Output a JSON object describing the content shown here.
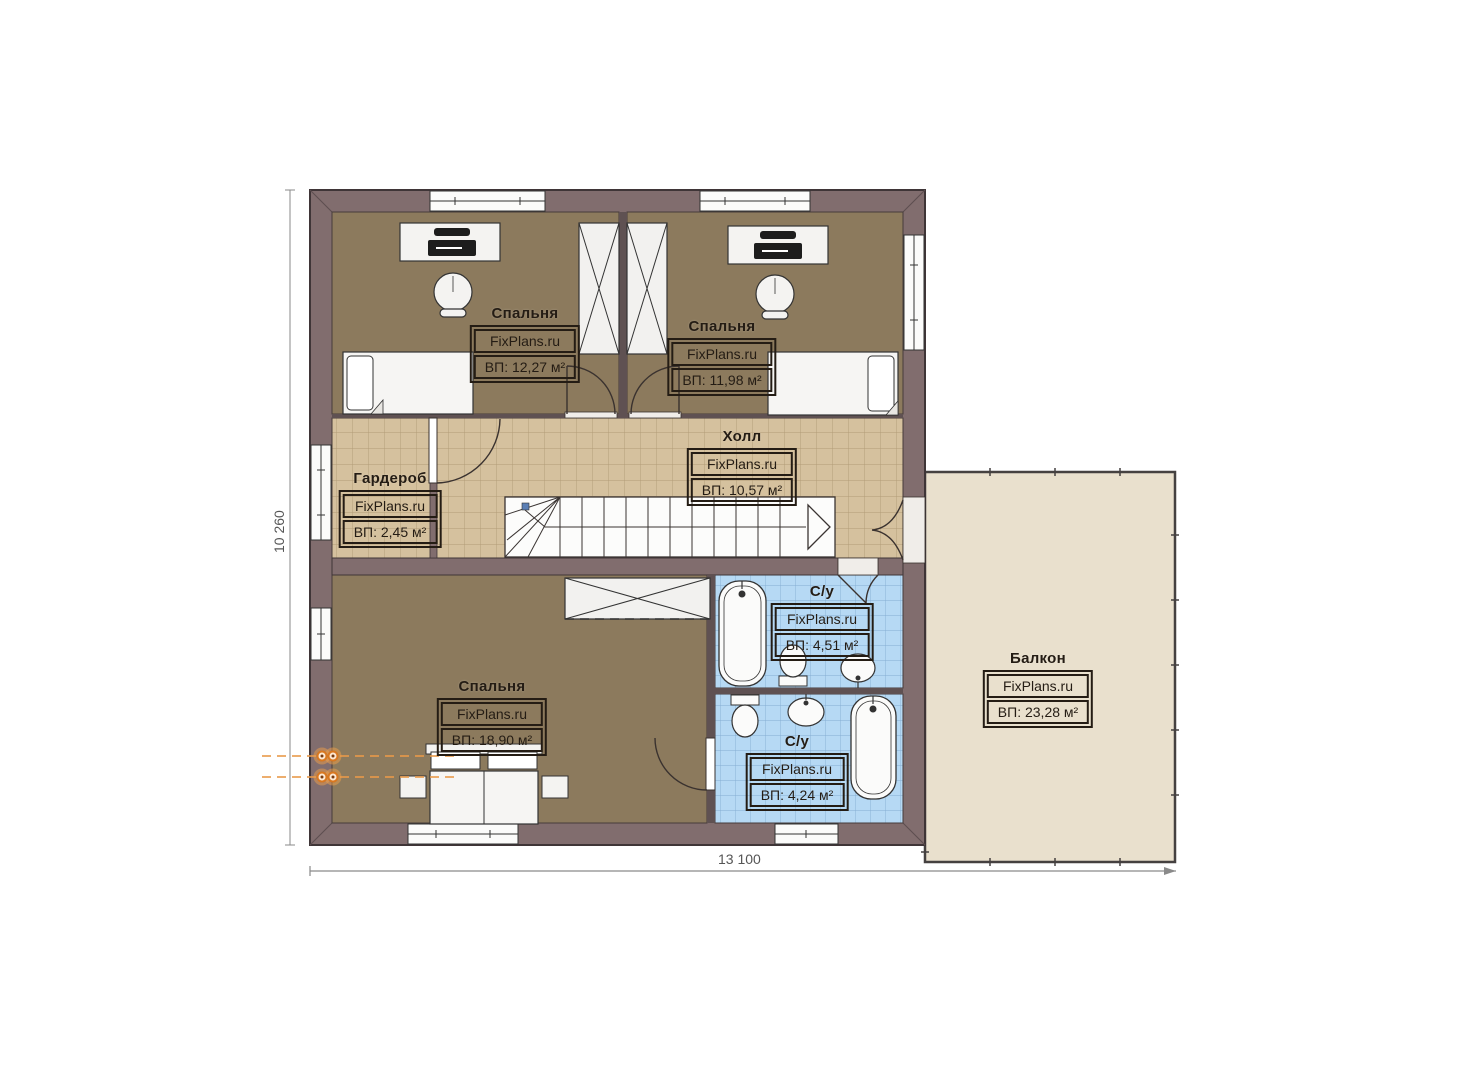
{
  "plan": {
    "watermark": "FixPlans.ru",
    "rooms": [
      {
        "id": "bedroom-top-left",
        "name": "Спальня",
        "area": "ВП: 12,27 м²"
      },
      {
        "id": "bedroom-top-right",
        "name": "Спальня",
        "area": "ВП: 11,98 м²"
      },
      {
        "id": "hall",
        "name": "Холл",
        "area": "ВП: 10,57 м²"
      },
      {
        "id": "wardrobe",
        "name": "Гардероб",
        "area": "ВП: 2,45 м²"
      },
      {
        "id": "bathroom-top",
        "name": "С/у",
        "area": "ВП: 4,51 м²"
      },
      {
        "id": "bedroom-bottom",
        "name": "Спальня",
        "area": "ВП: 18,90 м²"
      },
      {
        "id": "bathroom-bottom",
        "name": "С/у",
        "area": "ВП: 4,24 м²"
      },
      {
        "id": "balcony",
        "name": "Балкон",
        "area": "ВП: 23,28 м²"
      }
    ],
    "dimensions": {
      "height_label": "10 260",
      "width_label": "13 100"
    },
    "colors": {
      "wall": "#816d6e",
      "wall_dark": "#5f5152",
      "bedroom_floor": "#8c7a5d",
      "hall_tile": "#d5c19e",
      "hall_tile_line": "#a8906b",
      "bath_tile": "#b6d9f4",
      "bath_tile_line": "#7ba6cd",
      "balcony_floor": "#e9e0cd",
      "fixture_white": "#fbfbfa",
      "heating_accent": "#e2821f",
      "dimension_text": "#555555"
    }
  }
}
